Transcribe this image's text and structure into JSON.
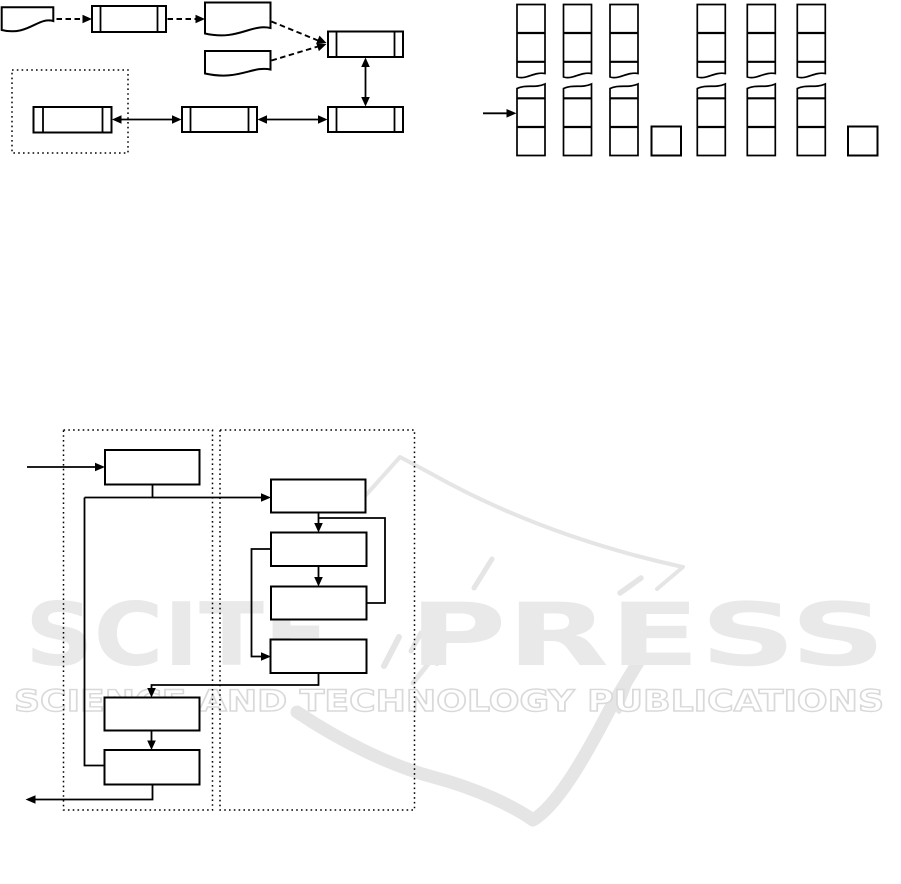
{
  "colors": {
    "background": "#ffffff",
    "ink": "#000000",
    "watermark_fill": "#e9e9e9",
    "watermark_outline": "#d9d9d9",
    "watermark_graphic": "#e5e5e5"
  },
  "watermark": {
    "brand": "SCITEPRESS",
    "brand_left": "SCITE",
    "brand_right": "PRESS",
    "tagline": "SCIENCE AND TECHNOLOGY PUBLICATIONS"
  },
  "figures": {
    "pipeline_diagram": {
      "documents": 3,
      "process_boxes": 5,
      "dashed_arrows": 4,
      "double_headed_arrows": 3,
      "dotted_regions": 1
    },
    "stack_diagram": {
      "torn_columns": 6,
      "cells_per_top_fragment": 3,
      "cells_per_bottom_fragment": 3,
      "detached_squares": 2,
      "entry_arrows": 1
    },
    "flowchart_diagram": {
      "dotted_regions": 2,
      "boxes": 8,
      "entry_arrows": 1,
      "exit_arrows": 1
    }
  }
}
